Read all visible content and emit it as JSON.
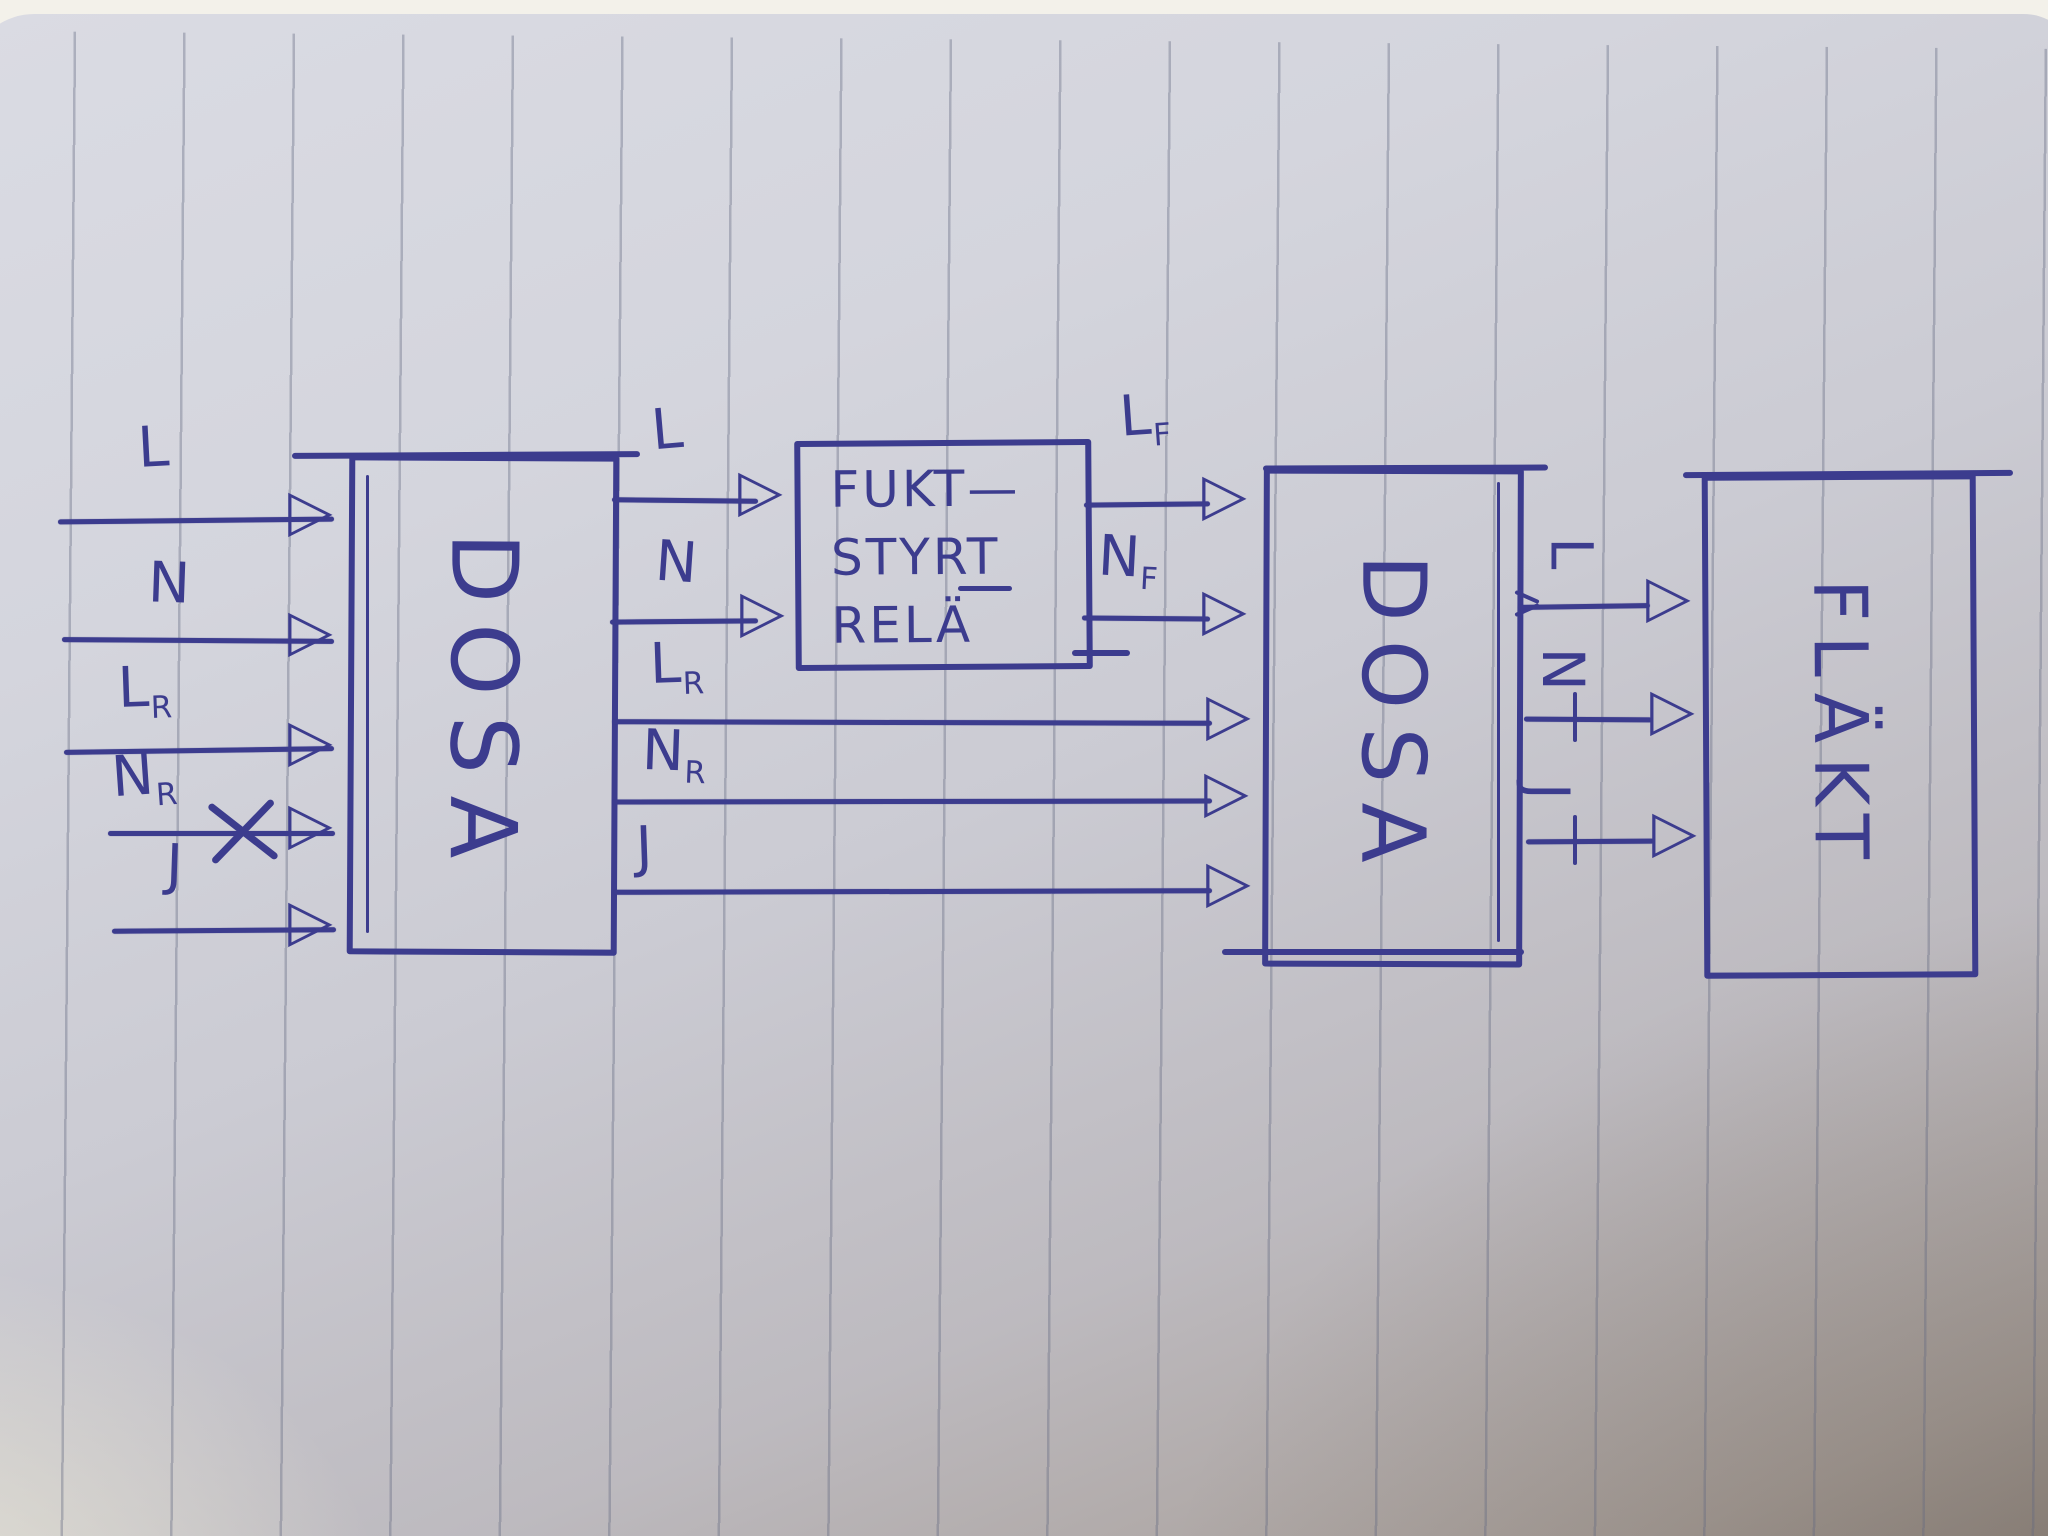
{
  "colors": {
    "ink": "#3c3c8e",
    "paper": "#d6d7df"
  },
  "icons": {
    "arrowhead": "▷"
  },
  "boxes": {
    "dosa1": {
      "label": "DOSA"
    },
    "relay": {
      "lines": [
        "FUKT—",
        "STYRT",
        "RELÄ"
      ]
    },
    "dosa2": {
      "label": "DOSA"
    },
    "flakt": {
      "label": "FLÄKT"
    }
  },
  "left_inputs": [
    {
      "label": "L"
    },
    {
      "label": "N"
    },
    {
      "label": "L",
      "sub": "R"
    },
    {
      "label": "N",
      "sub": "R",
      "crossed_out": true
    },
    {
      "label": "J"
    }
  ],
  "dosa1_to_relay": [
    {
      "label": "L"
    },
    {
      "label": "N"
    }
  ],
  "dosa1_to_dosa2": [
    {
      "label": "L",
      "sub": "R"
    },
    {
      "label": "N",
      "sub": "R"
    },
    {
      "label": "J"
    }
  ],
  "relay_to_dosa2": [
    {
      "label": "L",
      "sub": "F"
    },
    {
      "label": "N",
      "sub": "F"
    }
  ],
  "dosa2_to_flakt": [
    {
      "label": "L"
    },
    {
      "label": "N"
    },
    {
      "label": "J"
    }
  ]
}
